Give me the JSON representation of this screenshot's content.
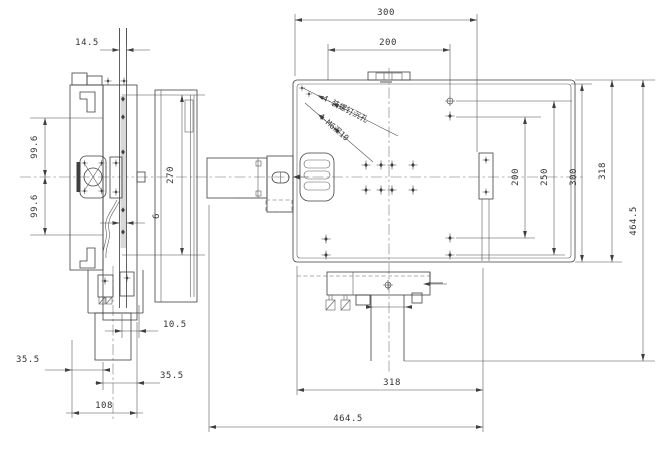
{
  "drawing": {
    "kind": "two-view mechanical engineering drawing of an XY positioning stage",
    "colors": {
      "line": "#3f3f3f",
      "dimension": "#4a4a4a",
      "background": "#ffffff"
    }
  },
  "dims": {
    "side": {
      "top_width": "14.5",
      "upper_height": "99.6",
      "lower_height": "99.6",
      "total_height": "270",
      "rail_width": "6",
      "plate_offset": "10.5",
      "left_edge": "35.5",
      "right_edge": "35.5",
      "base_width": "108"
    },
    "plan": {
      "top_outer": "300",
      "top_inner": "200",
      "right_1": "200",
      "right_2": "250",
      "right_3": "300",
      "right_4": "318",
      "right_total": "464.5",
      "bottom_width": "318",
      "bottom_total": "464.5"
    }
  },
  "annotations": {
    "counterbore": "4-装螺钉沉孔",
    "tapped": "4-M6深10"
  }
}
